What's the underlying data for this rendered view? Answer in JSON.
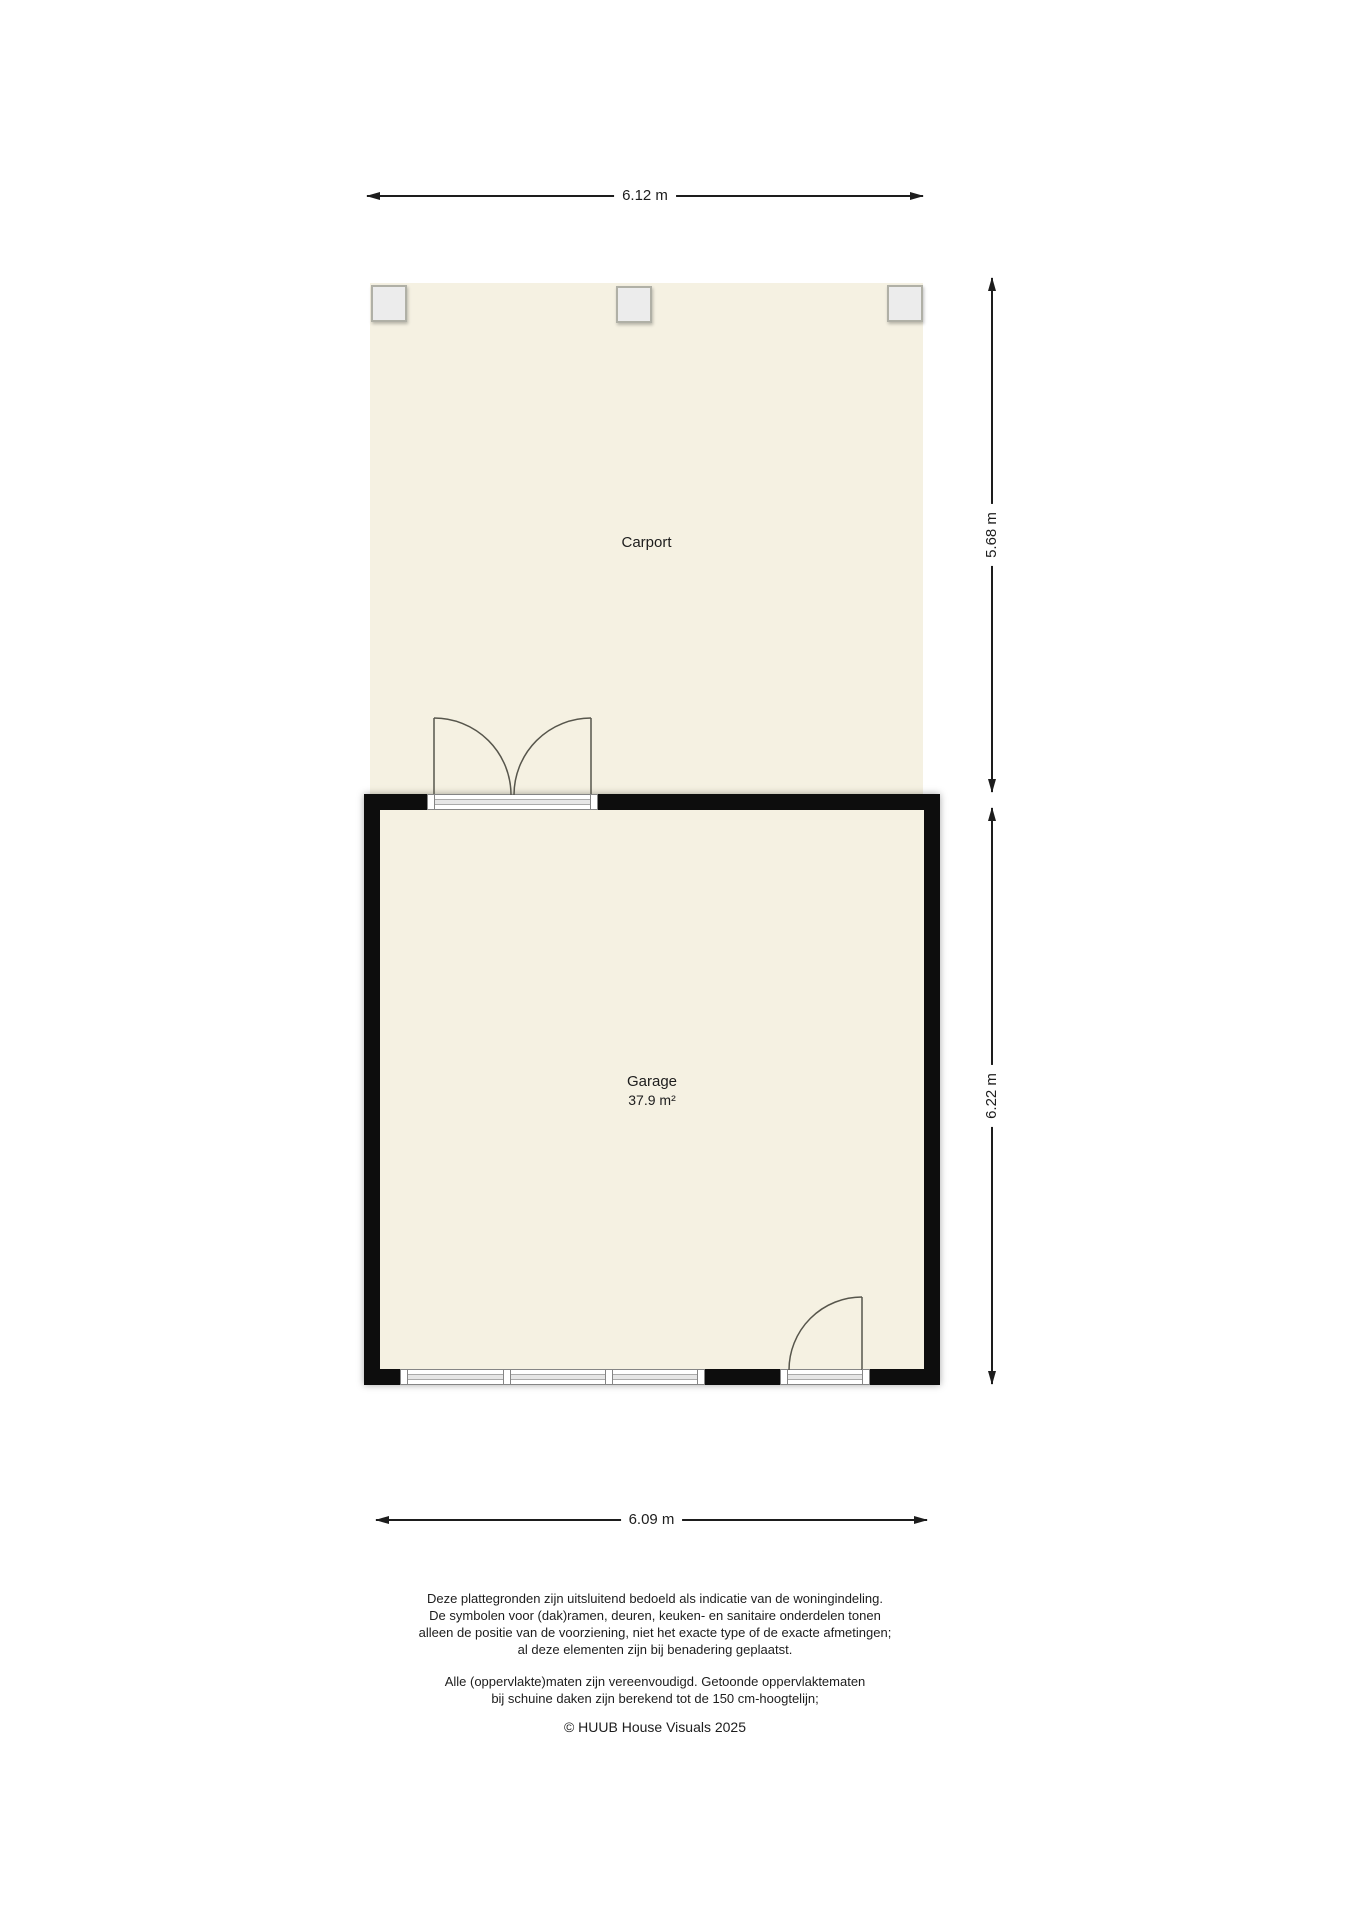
{
  "floorplan": {
    "rooms": [
      {
        "name": "Carport",
        "area": ""
      },
      {
        "name": "Garage",
        "area": "37.9 m²"
      }
    ],
    "dimensions": {
      "top_width": "6.12 m",
      "carport_depth": "5.68 m",
      "garage_depth": "6.22 m",
      "bottom_width": "6.09 m"
    },
    "colors": {
      "floor": "#f5f1e2",
      "wall": "#0d0d0d",
      "post_fill": "#ececec",
      "door_line": "#57564c",
      "dimension": "#1d1d1d"
    },
    "footer": {
      "disclaimer1": [
        "Deze plattegronden zijn uitsluitend bedoeld als indicatie van de woningindeling.",
        "De symbolen voor (dak)ramen, deuren, keuken- en sanitaire onderdelen tonen",
        "alleen de positie van de voorziening, niet het exacte type of de exacte afmetingen;",
        "al deze elementen zijn bij benadering geplaatst."
      ],
      "disclaimer2": [
        "Alle (oppervlakte)maten zijn vereenvoudigd. Getoonde oppervlaktematen",
        "bij schuine daken zijn berekend tot de 150 cm-hoogtelijn;"
      ],
      "copyright": "© HUUB House Visuals 2025"
    }
  }
}
